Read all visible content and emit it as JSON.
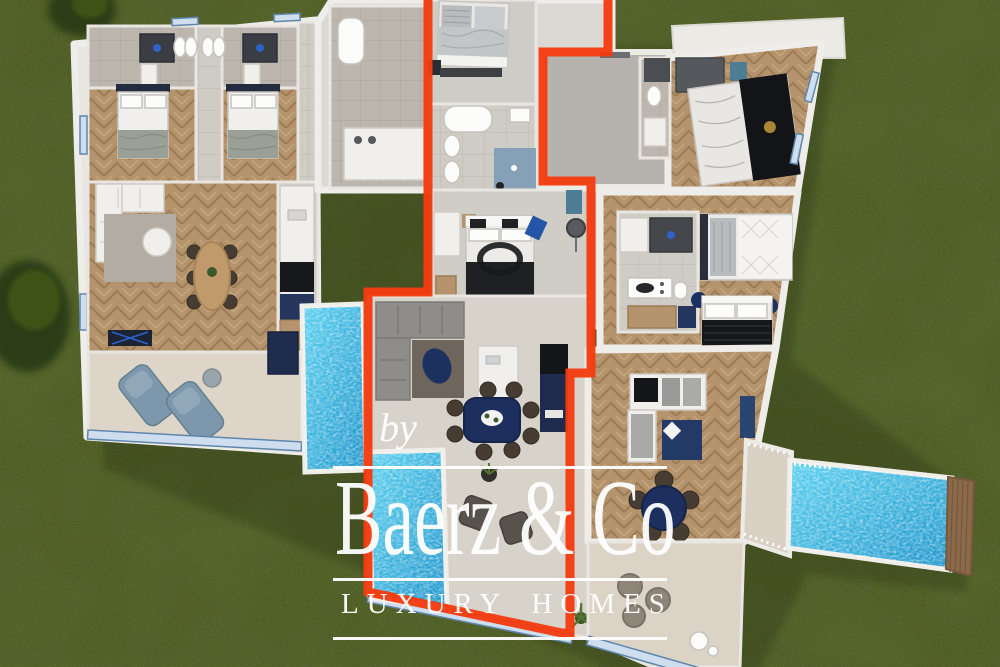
{
  "watermark": {
    "prefix": "by",
    "brand": "Baerz & Co",
    "tagline": "LUXURY HOMES"
  },
  "colors": {
    "grass": "#4d5c25",
    "outline": "#f43b10",
    "pool": "#5cd1f0",
    "pool_deep": "#1f95cb",
    "wood": "#b5946d",
    "tile": "#cfccc6",
    "terrace": "#dbd4c6",
    "concrete": "#b6b3ae",
    "wall": "#efede9",
    "navy": "#1d3160",
    "slate": "#7d97ac",
    "glazing": "#cfdeee"
  }
}
